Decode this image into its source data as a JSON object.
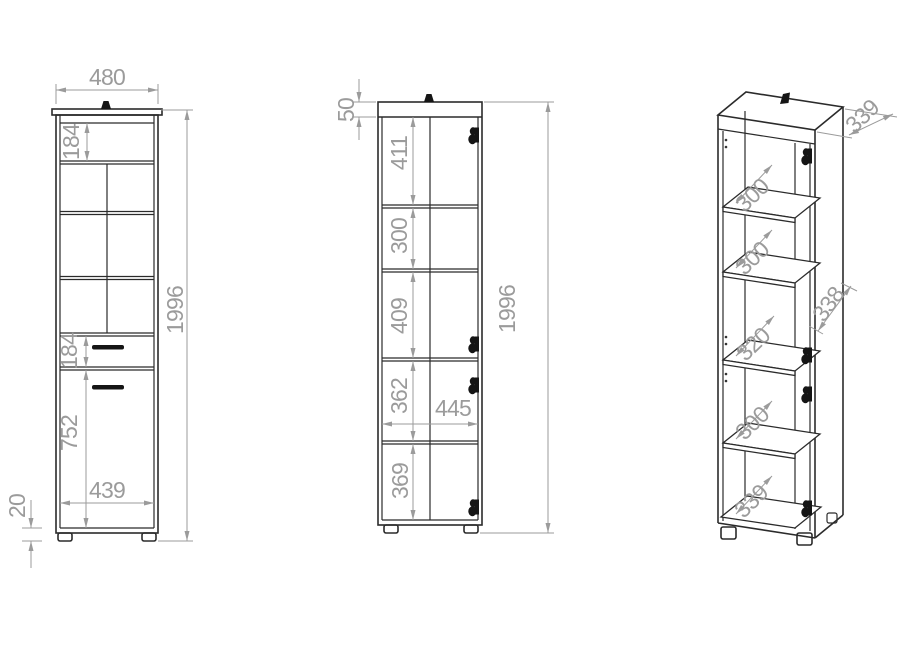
{
  "meta": {
    "background": "#ffffff",
    "line_color": "#2b2b2b",
    "dimension_color": "#9b9b9b"
  },
  "front": {
    "overall_width": "480",
    "top_compartment": "184",
    "overall_height": "1996",
    "drawer_height": "184",
    "door_height": "752",
    "interior_width": "439",
    "plinth_height": "20"
  },
  "section": {
    "top_panel": "50",
    "s1": "411",
    "s2": "300",
    "s3": "409",
    "s4": "362",
    "s5": "369",
    "interior_width": "445",
    "overall_height": "1996"
  },
  "isometric": {
    "top_depth": "339",
    "gap1": "300",
    "gap2": "300",
    "side_depth": "338",
    "gap3": "320",
    "gap4": "300",
    "bottom_gap": "339"
  }
}
